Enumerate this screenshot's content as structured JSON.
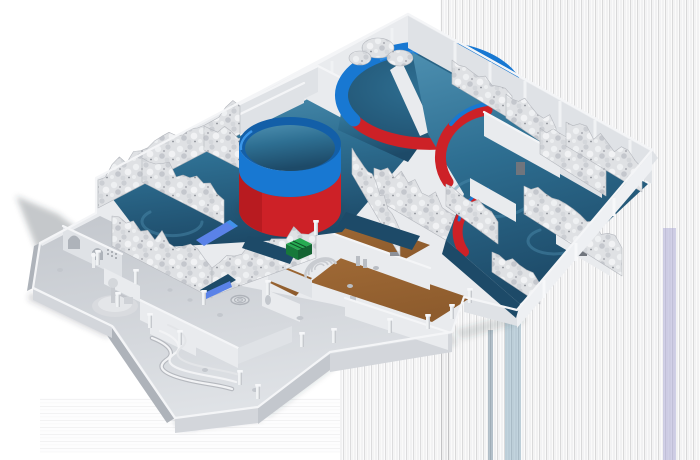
{
  "scene": {
    "type": "3d-isometric-cutaway-render",
    "subject": "Aquarium exhibit building cutaway model",
    "description": "Isometric cutaway render of a themed aquarium building: rock-work exhibit rooms with dark water floors and a winding magenta visitor route, a cylindrical tank with blue rim and red base, a large circular ring tank, crescent tank walls, a wood-floored lobby and a gray back-of-house service wing"
  },
  "colors": {
    "background": "#ffffff",
    "wall_top": "#f4f5f7",
    "wall_light": "#e9ebee",
    "wall_face": "#dfe2e6",
    "wall_mid": "#d3d6db",
    "wall_shade": "#c3c7cd",
    "wall_dark": "#aeb3ba",
    "floor_gray": "#cdd0d5",
    "rock_base": "#dfe1e4",
    "water_deep": "#1d4a68",
    "water": "#2e6f92",
    "water_light": "#4d8fb0",
    "tank_blue": "#1878d2",
    "tank_blue_dark": "#135fa8",
    "tank_blue_light": "#3b96e8",
    "tank_red": "#cd2127",
    "tank_red_dark": "#a01318",
    "path_magenta": "#cf1288",
    "wood": "#8e5c2d",
    "wood_light": "#a06a36",
    "crate_green": "#27ab52",
    "crate_green_dark": "#17793a",
    "slide_blue": "#5a82e8",
    "shadow": "#343a42",
    "streak_gray": "#bcbcc0",
    "streak_lavender": "#a8a6d4"
  },
  "objects": [
    {
      "id": "exhibit-wing-left",
      "name": "rock-walled exhibit rooms with water floors"
    },
    {
      "id": "cylindrical-tank",
      "name": "cylindrical tank, blue rim and red base"
    },
    {
      "id": "ring-tank",
      "name": "large circular tank with blue ring and red arc"
    },
    {
      "id": "crescent-tank-walls",
      "name": "red crescent tank walls"
    },
    {
      "id": "visitor-path",
      "name": "magenta visitor route line"
    },
    {
      "id": "lobby",
      "name": "wood-floored entry hall with props"
    },
    {
      "id": "service-wing",
      "name": "gray back-of-house service area"
    },
    {
      "id": "green-crate",
      "name": "green crate"
    },
    {
      "id": "blue-slide",
      "name": "blue flume section"
    }
  ]
}
